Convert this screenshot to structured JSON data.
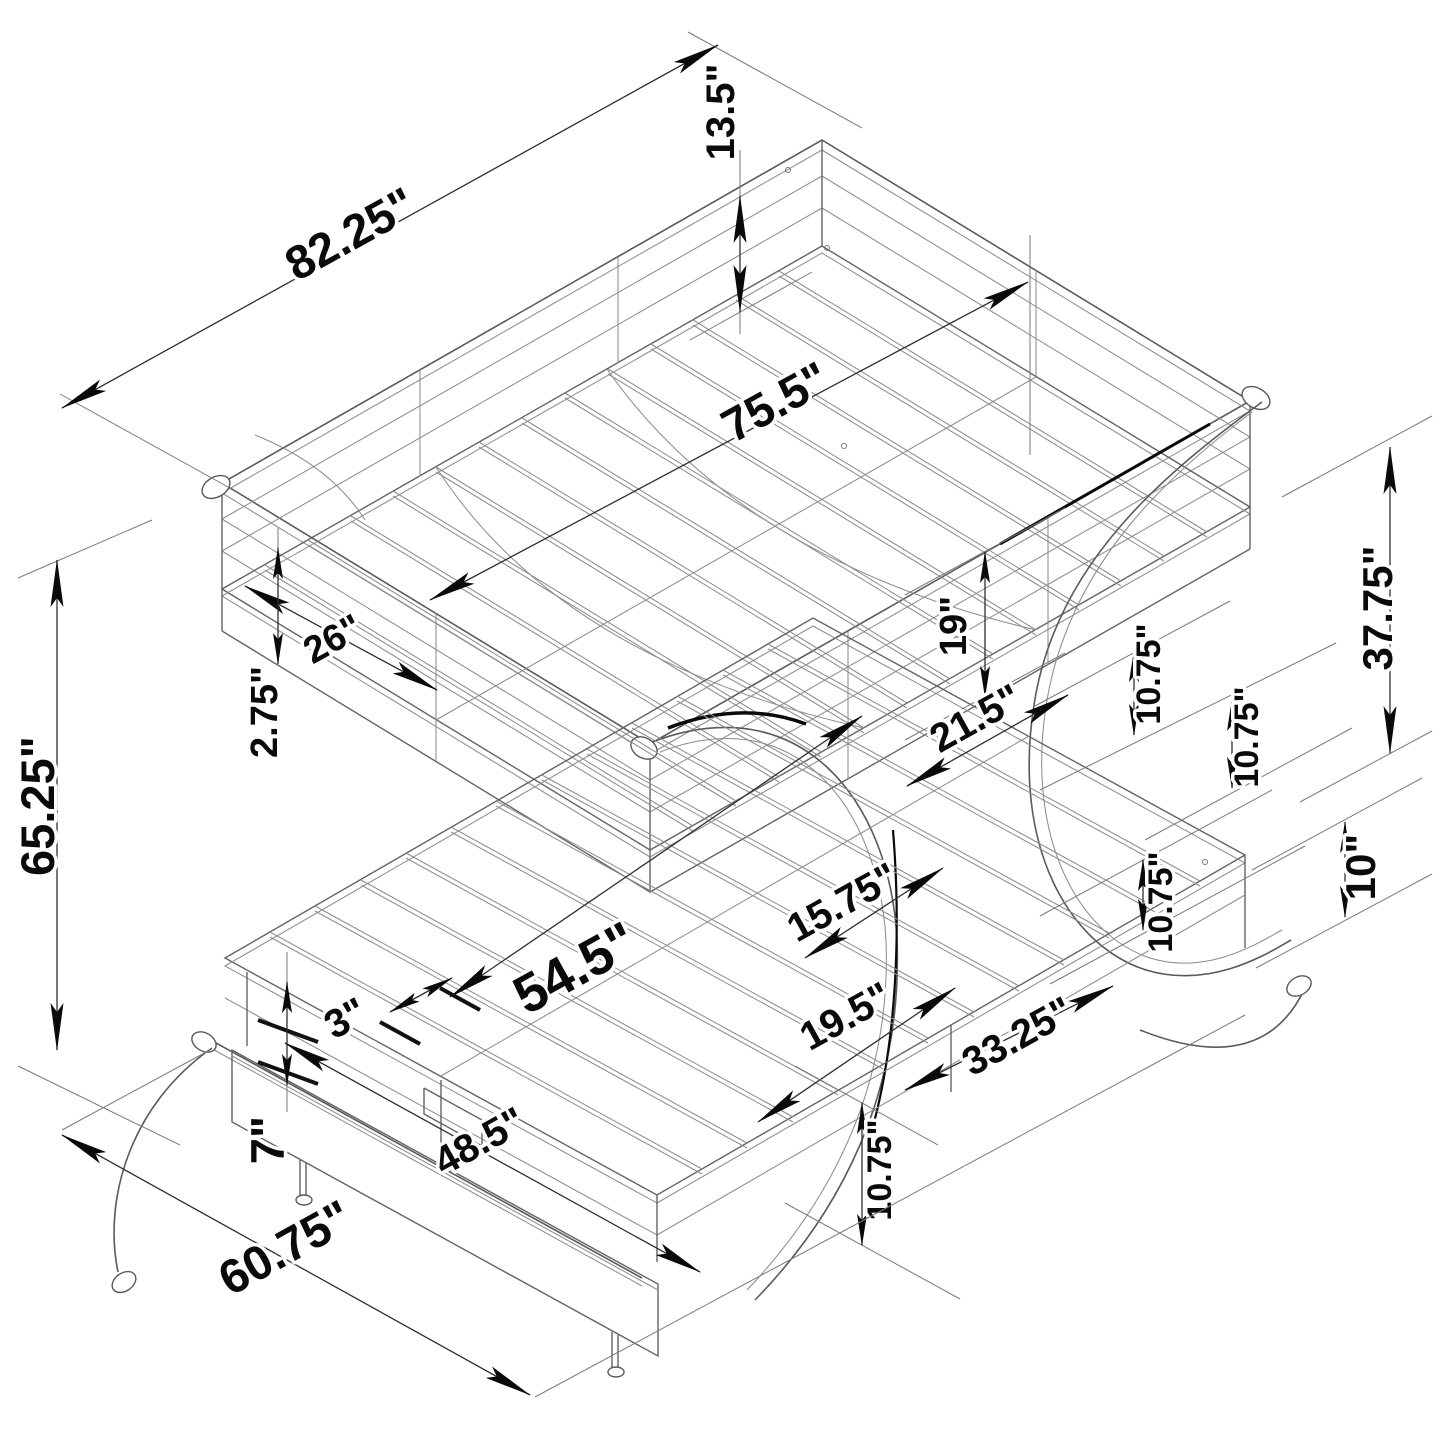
{
  "page": {
    "background": "#ffffff",
    "kind": "isometric furniture dimension drawing",
    "subject": "bunk bed with futon base, trundle and C-shaped legs"
  },
  "drawing": {
    "line_color": "#636363",
    "dimension_color": "#2f2f2f",
    "text_color": "#0a0a0a",
    "labels": [
      {
        "text": "82.25\""
      },
      {
        "text": "13.5\""
      },
      {
        "text": "75.5\""
      },
      {
        "text": "26\""
      },
      {
        "text": "2.75\""
      },
      {
        "text": "19\""
      },
      {
        "text": "21.5\""
      },
      {
        "text": "10.75\""
      },
      {
        "text": "10.75\""
      },
      {
        "text": "37.75\""
      },
      {
        "text": "65.25\""
      },
      {
        "text": "15.75\""
      },
      {
        "text": "10.75\""
      },
      {
        "text": "10\""
      },
      {
        "text": "54.5\""
      },
      {
        "text": "3\""
      },
      {
        "text": "19.5\""
      },
      {
        "text": "33.25\""
      },
      {
        "text": "7\""
      },
      {
        "text": "48.5\""
      },
      {
        "text": "10.75\""
      },
      {
        "text": "60.75\""
      }
    ]
  }
}
